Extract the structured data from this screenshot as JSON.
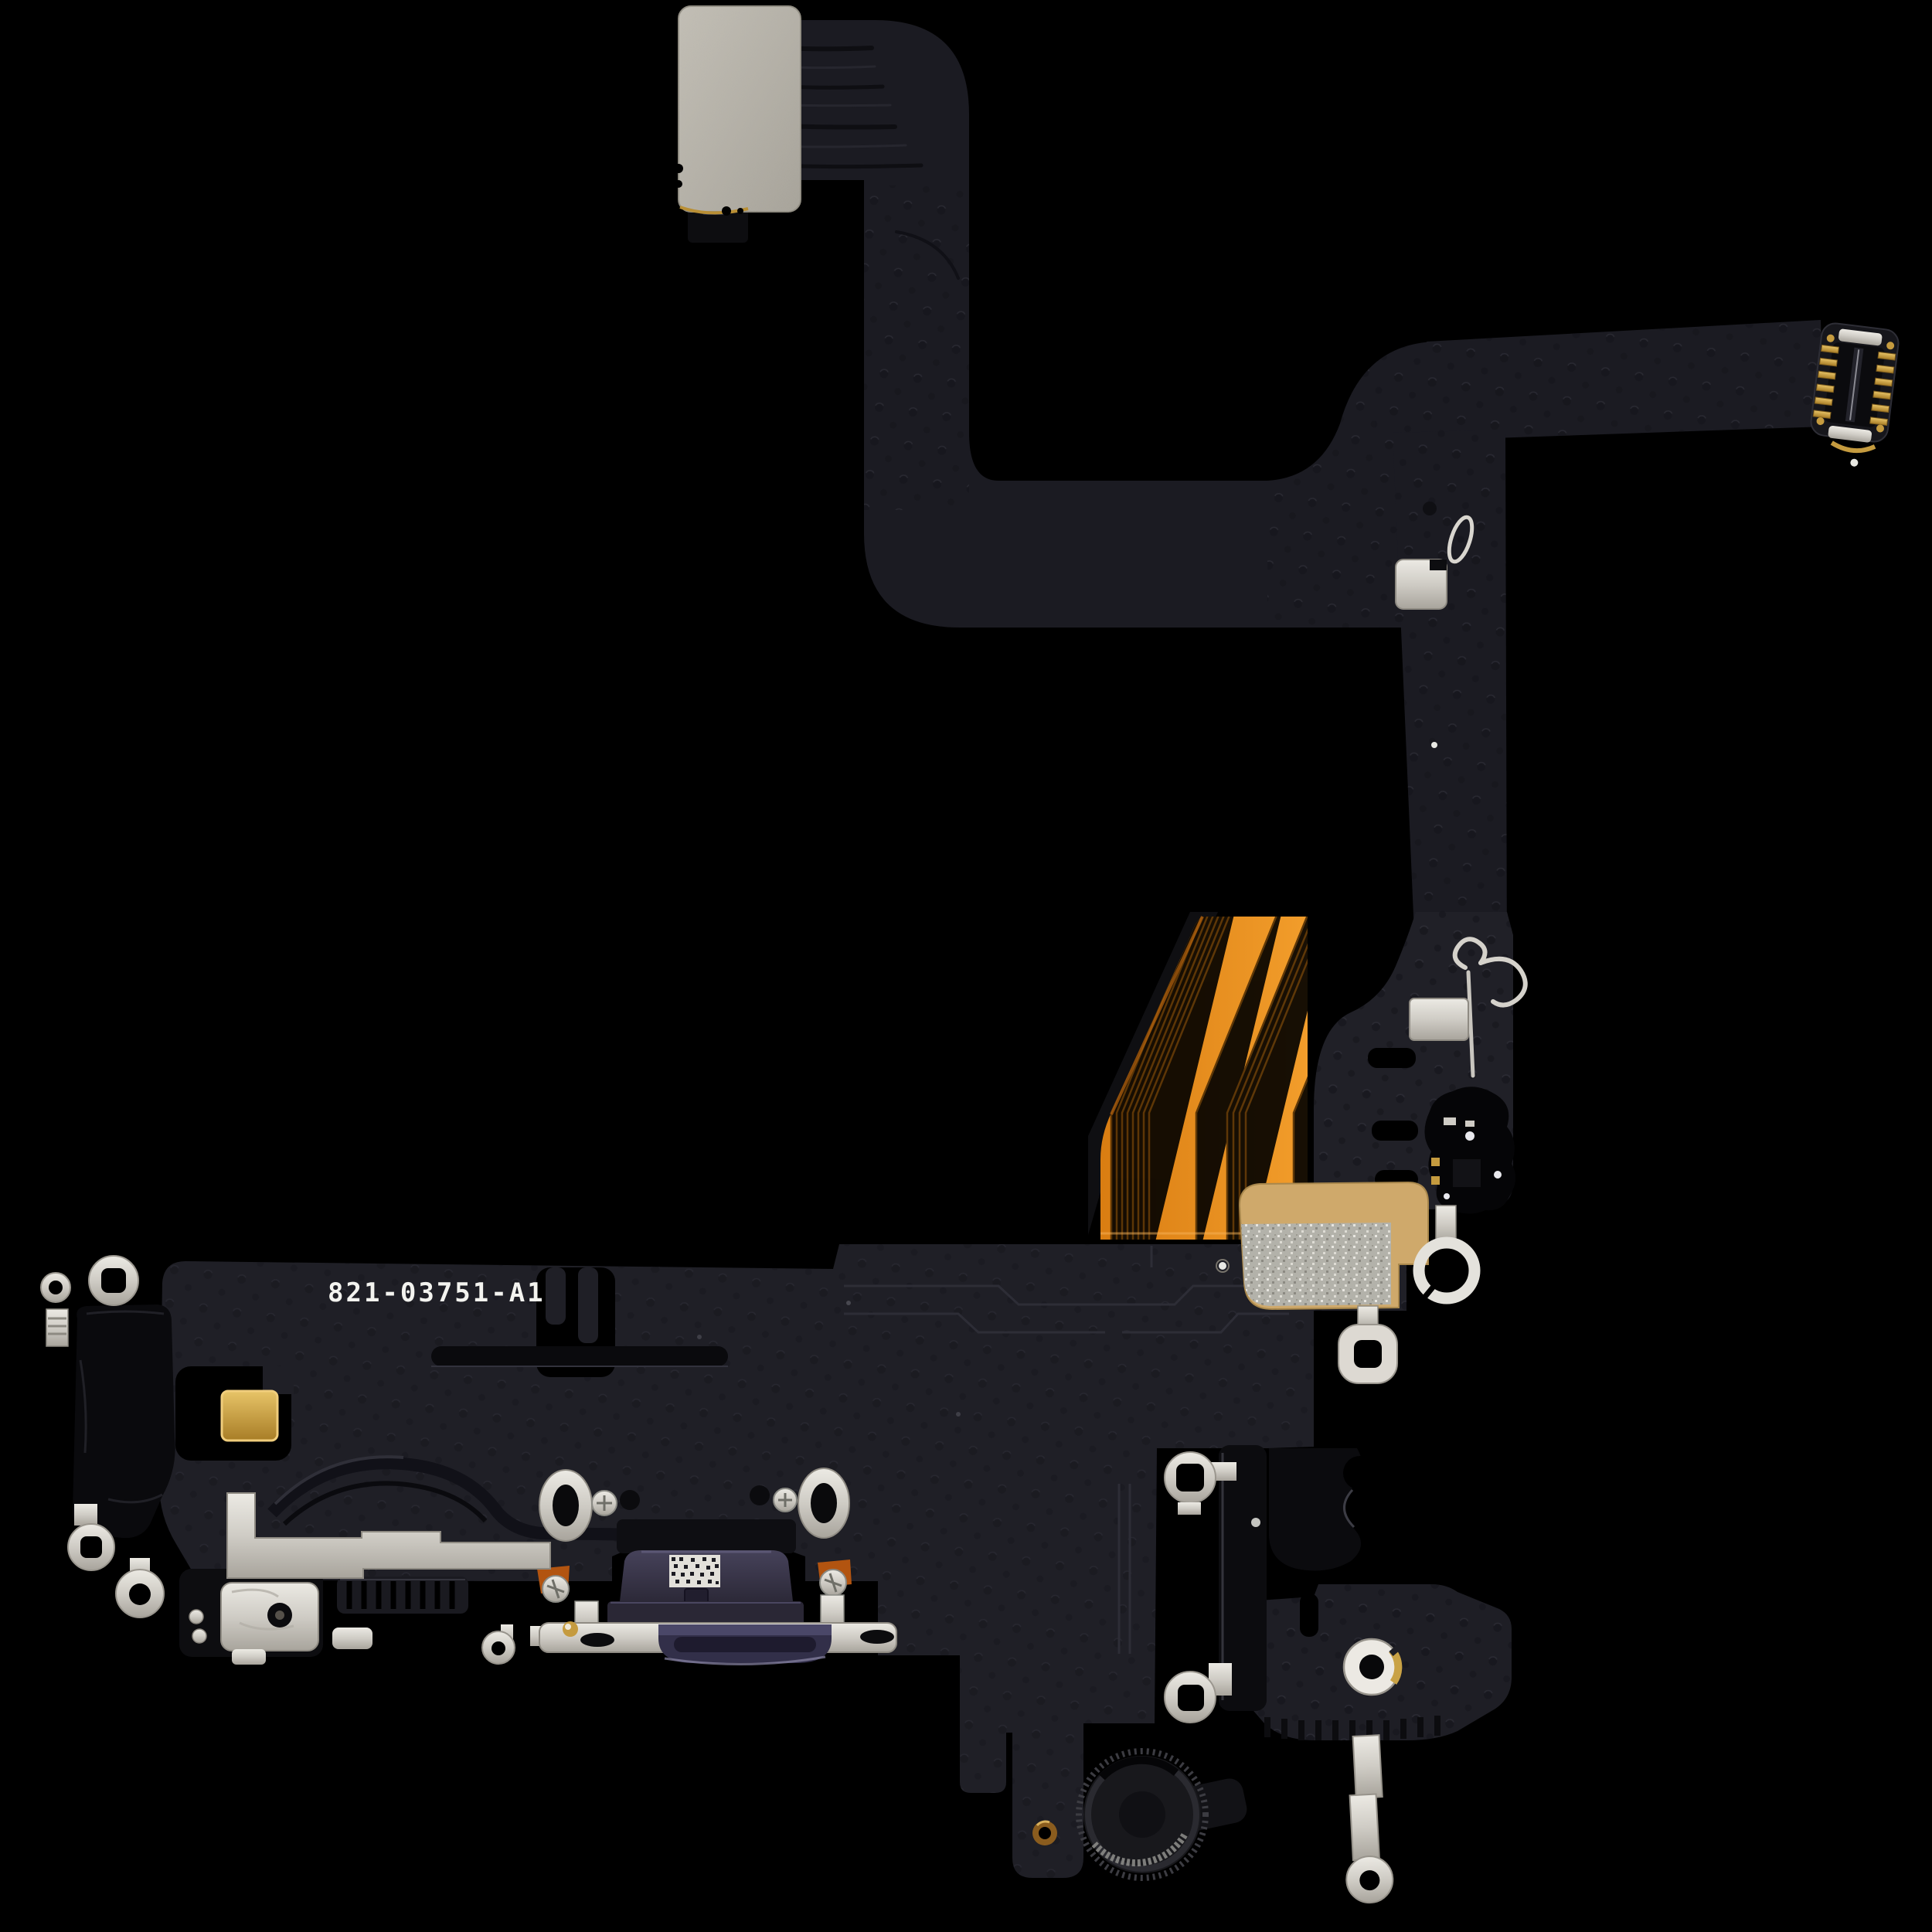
{
  "image": {
    "type": "product-photo",
    "subject": "iPhone charging port flex cable assembly, top view, isolated on black",
    "background": "#000000",
    "board_label": {
      "part_number": "821-03751-A1"
    },
    "palette": {
      "flex_black": "#1b1b22",
      "board_black": "#1f1f26",
      "glossy_black": "#0b0b0e",
      "kapton_orange": "#e88f1e",
      "stiffener_gray": "#b5b1a7",
      "metal_silver": "#dbd8d1",
      "contact_gold": "#d2a94f",
      "fabric_tan": "#cfa96b",
      "port_purple": "#3a374c"
    },
    "components": [
      "top flex stiffener pad",
      "folded flex ribbon",
      "board-to-board connector",
      "orange kapton flex fold",
      "main board plate",
      "lightning port with code sticker",
      "metal shield bracket",
      "mounting grommets and screws",
      "grounding ring lugs",
      "antenna spring contacts",
      "bottom microphone",
      "metal retaining strap",
      "fabric shielding pad"
    ]
  }
}
